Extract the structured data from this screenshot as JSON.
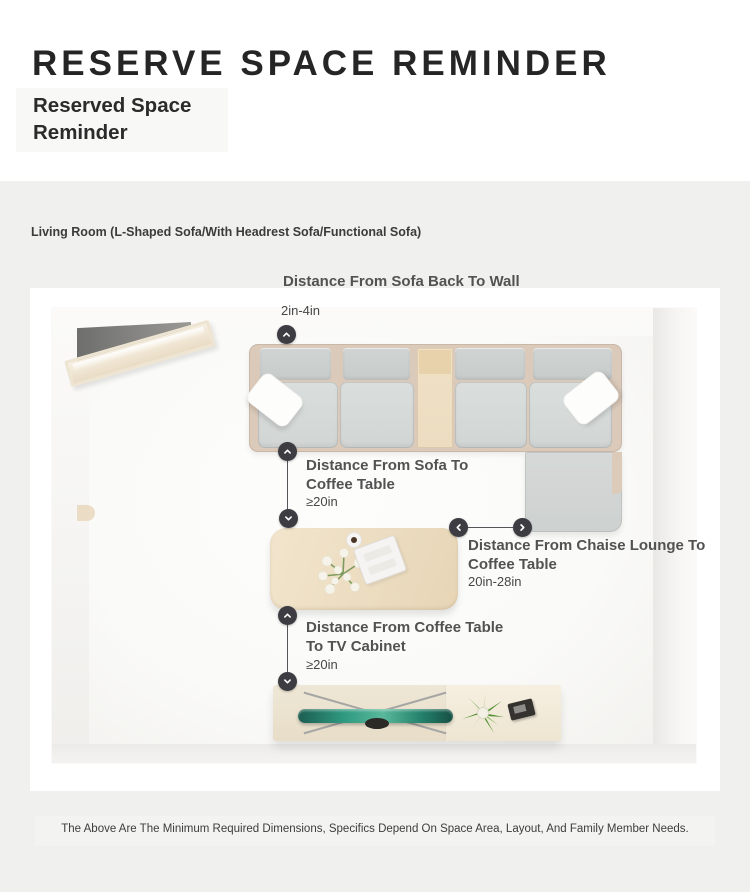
{
  "header": {
    "title": "RESERVE SPACE REMINDER",
    "subtitle": "Reserved Space\nReminder"
  },
  "section": {
    "label": "Living Room (L-Shaped Sofa/With Headrest Sofa/Functional Sofa)"
  },
  "annotations": {
    "sofa_back_wall": {
      "label": "Distance From Sofa Back To Wall",
      "value": "2in-4in"
    },
    "sofa_coffee": {
      "label": "Distance From Sofa To Coffee Table",
      "value": "≥20in"
    },
    "chaise_coffee": {
      "label": "Distance From Chaise Lounge To Coffee Table",
      "value": "20in-28in"
    },
    "coffee_tv": {
      "label": "Distance From Coffee Table To TV Cabinet",
      "value": "≥20in"
    }
  },
  "footer": {
    "note": "The Above Are The Minimum Required Dimensions, Specifics Depend On Space Area, Layout, And Family Member Needs."
  },
  "icons": {
    "marker_up": "chevron-up",
    "marker_down": "chevron-down",
    "marker_left": "chevron-left",
    "marker_right": "chevron-right"
  },
  "colors": {
    "section_bg": "#f0f0ee",
    "card_bg": "#ffffff",
    "marker_bg": "#3c3c42",
    "label_text": "#525252",
    "value_text": "#474747",
    "sofa_frame": "#dbcaba",
    "cushion_gray": "#d5d8d7",
    "wood_light": "#ecdcc1",
    "tv_teal": "#2b8a74"
  }
}
